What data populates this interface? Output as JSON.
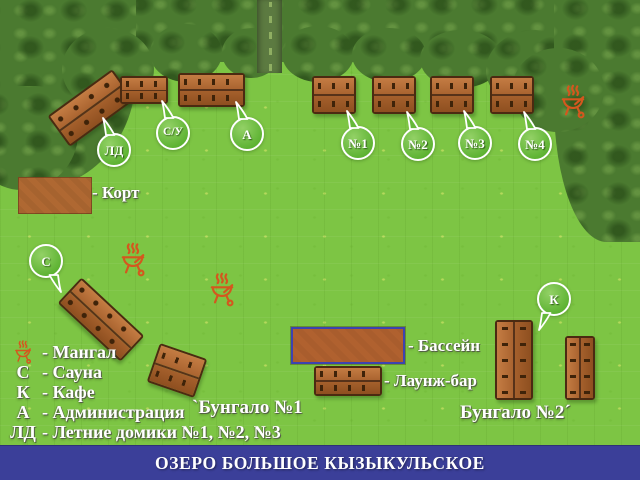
{
  "banner": {
    "title": "ОЗЕРО БОЛЬШОЕ КЫЗЫКУЛЬСКОЕ"
  },
  "map": {
    "bubbles": {
      "ld": "ЛД",
      "su": "С/У",
      "admin": "А",
      "n1": "№1",
      "n2": "№2",
      "n3": "№3",
      "n4": "№4",
      "sauna": "С",
      "cafe": "К"
    },
    "labels": {
      "court": "- Корт",
      "pool": "- Бассейн",
      "lounge_bar": "- Лаунж-бар",
      "bungalow1": "`Бунгало №1",
      "bungalow2": "Бунгало №2´"
    }
  },
  "legend": {
    "items": [
      {
        "key": "",
        "text": "- Мангал"
      },
      {
        "key": "С",
        "text": "- Сауна"
      },
      {
        "key": "К",
        "text": "- Кафе"
      },
      {
        "key": "А",
        "text": "- Администрация"
      },
      {
        "key": "ЛД",
        "text": "- Летние домики №1, №2, №3"
      }
    ]
  },
  "colors": {
    "grass": "#7dc544",
    "trees": "#4b7a30",
    "cabin_light": "#c47c43",
    "cabin_dark": "#8e4f20",
    "grill_icon": "#d4571e",
    "pool_border": "#3d43b0",
    "bubble_green": "#5cb231",
    "banner_bg": "#3b3f99"
  }
}
